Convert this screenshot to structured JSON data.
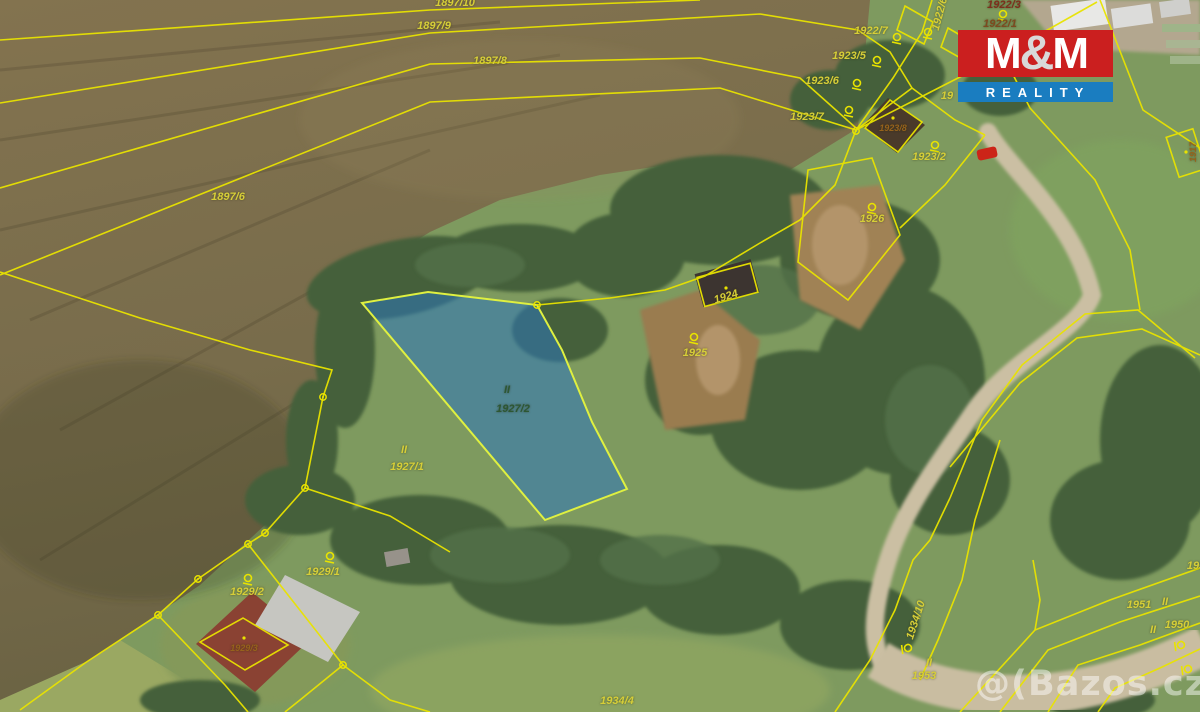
{
  "map": {
    "type": "cadastral-aerial-map",
    "watermark": {
      "text": "@(Bazos.cz"
    },
    "logo": {
      "m1": "M",
      "amp": "&",
      "m2": "M",
      "reality": "REALITY",
      "red": "#cb1f1f",
      "blue": "#1a7dc0"
    },
    "highlight": {
      "parcel": "1927/2",
      "fill": "rgba(44,118,188,0.55)",
      "stroke": "#dff040"
    },
    "style": {
      "line_color": "#e9e300",
      "label_color": "#d6ce38",
      "building_label_color": "#96621c",
      "highlight_label_color": "#2d5733"
    },
    "parcel_labels": [
      {
        "text": "1897/10",
        "x": 455,
        "y": 3
      },
      {
        "text": "1897/9",
        "x": 434,
        "y": 26
      },
      {
        "text": "1897/8",
        "x": 490,
        "y": 61
      },
      {
        "text": "1897/6",
        "x": 228,
        "y": 197
      },
      {
        "text": "1922/7",
        "x": 871,
        "y": 31
      },
      {
        "text": "1922/6",
        "x": 940,
        "y": 14,
        "rot": -75
      },
      {
        "text": "1922/3",
        "x": 1004,
        "y": 5,
        "color": "#7d2f1d"
      },
      {
        "text": "1922/1",
        "x": 1000,
        "y": 24,
        "color": "#7d4a20"
      },
      {
        "text": "19",
        "x": 947,
        "y": 96
      },
      {
        "text": "1923/5",
        "x": 849,
        "y": 56
      },
      {
        "text": "1923/6",
        "x": 822,
        "y": 81
      },
      {
        "text": "1923/7",
        "x": 807,
        "y": 117
      },
      {
        "text": "1923/8",
        "x": 893,
        "y": 128,
        "color": "#96621c",
        "size": 9
      },
      {
        "text": "1923/2",
        "x": 929,
        "y": 157
      },
      {
        "text": "1926",
        "x": 872,
        "y": 219
      },
      {
        "text": "1925",
        "x": 695,
        "y": 353
      },
      {
        "text": "1924",
        "x": 726,
        "y": 297,
        "rot": -17
      },
      {
        "text": "II",
        "x": 507,
        "y": 390,
        "color": "#2d5733"
      },
      {
        "text": "1927/2",
        "x": 513,
        "y": 409,
        "color": "#2d5733"
      },
      {
        "text": "II",
        "x": 404,
        "y": 450
      },
      {
        "text": "1927/1",
        "x": 407,
        "y": 467
      },
      {
        "text": "1929/1",
        "x": 323,
        "y": 572
      },
      {
        "text": "1929/2",
        "x": 247,
        "y": 592
      },
      {
        "text": "1929/3",
        "x": 244,
        "y": 648,
        "color": "#96621c",
        "size": 9
      },
      {
        "text": "1934/4",
        "x": 617,
        "y": 701
      },
      {
        "text": "1934/10",
        "x": 916,
        "y": 620,
        "rot": -72
      },
      {
        "text": "1953",
        "x": 924,
        "y": 676
      },
      {
        "text": "II",
        "x": 929,
        "y": 663
      },
      {
        "text": "1951",
        "x": 1139,
        "y": 605
      },
      {
        "text": "II",
        "x": 1165,
        "y": 602
      },
      {
        "text": "1950",
        "x": 1177,
        "y": 625
      },
      {
        "text": "II",
        "x": 1153,
        "y": 630
      },
      {
        "text": "195",
        "x": 1196,
        "y": 566
      },
      {
        "text": "1917",
        "x": 1193,
        "y": 152,
        "rot": -90,
        "color": "#96621c",
        "size": 9
      }
    ],
    "omega_symbols": [
      {
        "x": 897,
        "y": 37
      },
      {
        "x": 928,
        "y": 32
      },
      {
        "x": 877,
        "y": 60
      },
      {
        "x": 857,
        "y": 83
      },
      {
        "x": 849,
        "y": 110
      },
      {
        "x": 1003,
        "y": 14
      },
      {
        "x": 935,
        "y": 145
      },
      {
        "x": 872,
        "y": 207
      },
      {
        "x": 694,
        "y": 337
      },
      {
        "x": 330,
        "y": 556
      },
      {
        "x": 248,
        "y": 578
      },
      {
        "x": 908,
        "y": 648,
        "rot": 70
      },
      {
        "x": 1181,
        "y": 645,
        "rot": 70
      },
      {
        "x": 1188,
        "y": 669,
        "rot": 70
      }
    ],
    "survey_markers": [
      {
        "x": 856,
        "y": 131
      },
      {
        "x": 537,
        "y": 305
      },
      {
        "x": 323,
        "y": 397
      },
      {
        "x": 305,
        "y": 488
      },
      {
        "x": 265,
        "y": 533
      },
      {
        "x": 248,
        "y": 544
      },
      {
        "x": 198,
        "y": 579
      },
      {
        "x": 158,
        "y": 615
      },
      {
        "x": 343,
        "y": 665
      }
    ],
    "building_dots": [
      {
        "x": 893,
        "y": 118
      },
      {
        "x": 244,
        "y": 638
      },
      {
        "x": 1186,
        "y": 152
      },
      {
        "x": 726,
        "y": 288
      }
    ]
  }
}
